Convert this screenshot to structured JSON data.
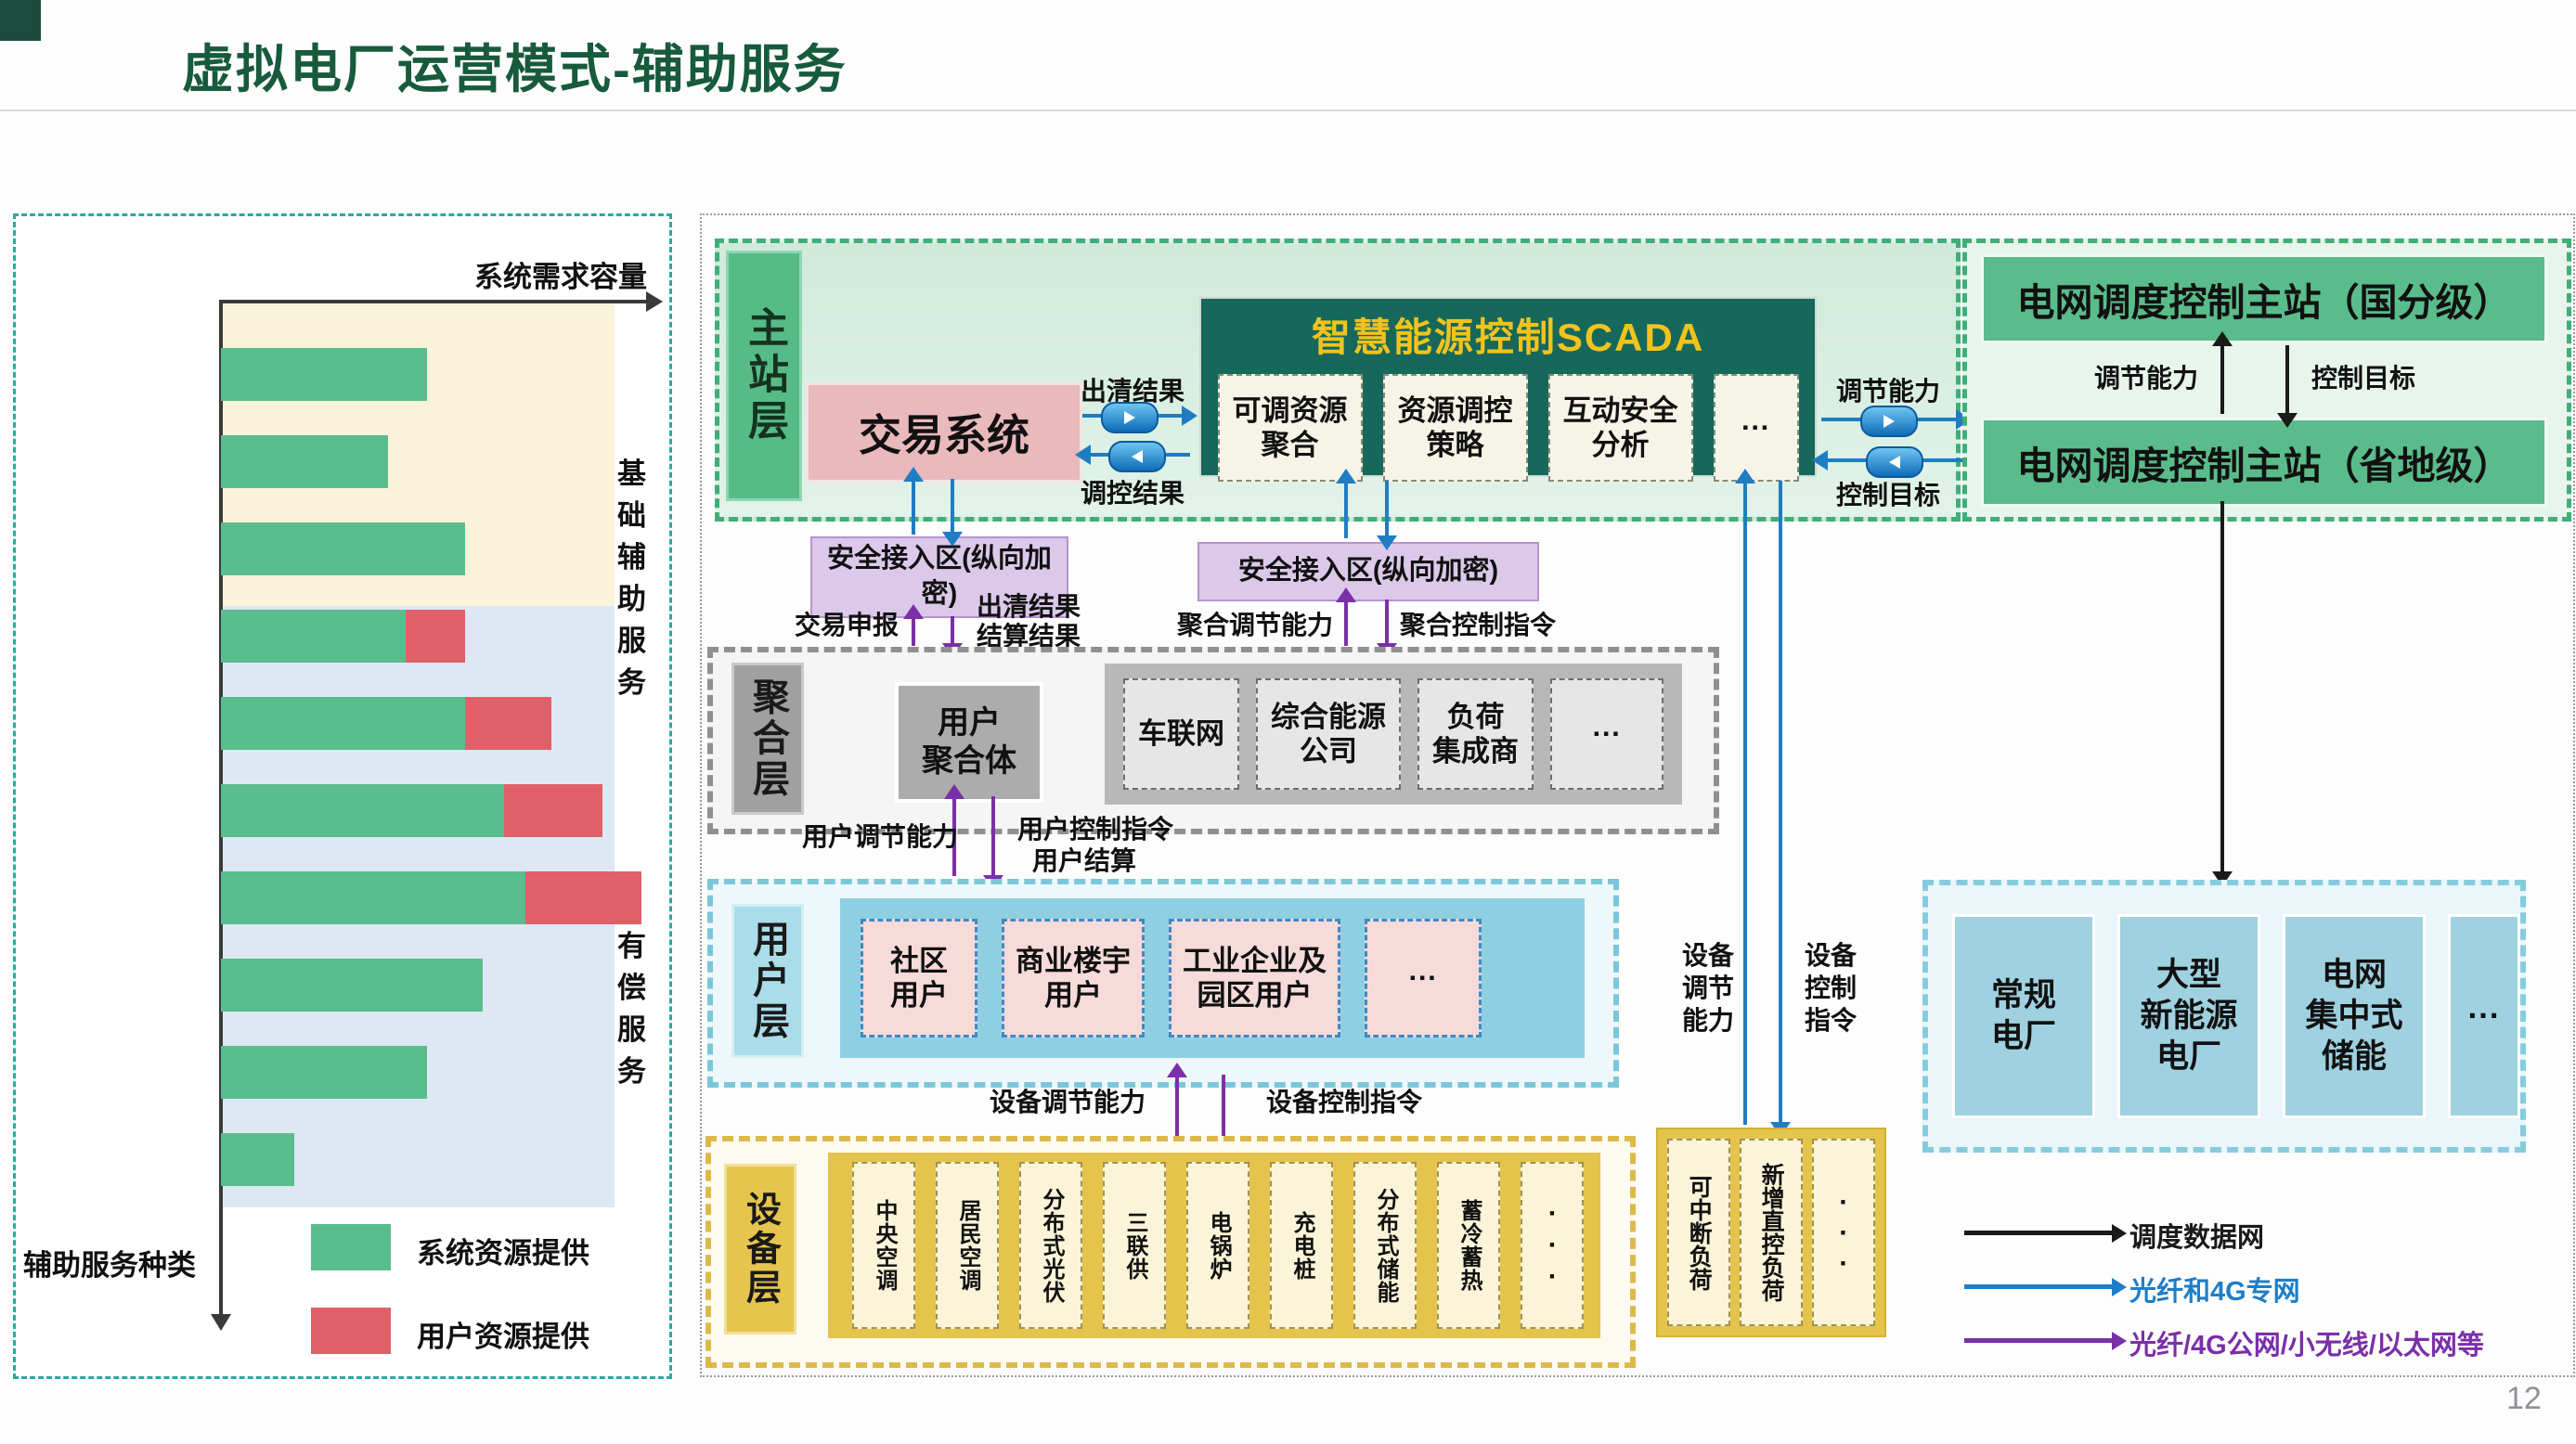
{
  "slide": {
    "title": "虚拟电厂运营模式-辅助服务",
    "page_number": "12"
  },
  "chart_data": {
    "type": "bar",
    "orientation": "horizontal",
    "xlabel": "系统需求容量",
    "ylabel": "辅助服务种类",
    "categories": [
      "一次调频",
      "基本调峰",
      "基本无功调节",
      "自动发电控制\nAGC",
      "旋转备用",
      "热备用",
      "有偿调峰",
      "有偿无功调节",
      "黑启动",
      ""
    ],
    "series": [
      {
        "name": "系统资源提供",
        "color": "#5abd8e",
        "values": [
          48,
          39,
          57,
          43,
          57,
          66,
          71,
          61,
          48,
          17
        ]
      },
      {
        "name": "用户资源提供",
        "color": "#e0606a",
        "values": [
          0,
          0,
          0,
          14,
          20,
          23,
          27,
          0,
          0,
          0
        ]
      }
    ],
    "xlim": [
      0,
      100
    ],
    "grid": false,
    "region_labels": [
      {
        "label": "基础\n辅助\n服务",
        "meaning": "基础辅助服务",
        "covers": "一次调频~基本无功调节"
      },
      {
        "label": "有偿\n服务",
        "meaning": "有偿服务",
        "covers": "自动发电控制AGC~黑启动"
      }
    ],
    "region_colors": {
      "basic": "#faf3d9",
      "paid": "#dde8f4"
    }
  },
  "diagram": {
    "layers": {
      "main": "主站层",
      "aggregation": "聚合层",
      "user": "用户层",
      "device": "设备层"
    },
    "trading_system": "交易系统",
    "scada": {
      "title": "智慧能源控制SCADA",
      "modules": [
        "可调资源\n聚合",
        "资源调控\n策略",
        "互动安全\n分析",
        "···"
      ]
    },
    "trading_scada_flows": {
      "right": "出清结果",
      "left": "调控结果"
    },
    "scada_dispatch_flows": {
      "up": "调节能力",
      "down": "控制目标"
    },
    "dispatch": {
      "national": "电网调度控制主站（国分级）",
      "provincial": "电网调度控制主站（省地级）",
      "up": "调节能力",
      "down": "控制目标"
    },
    "security_zone_left": {
      "label": "安全接入区(纵向加密)",
      "up": "交易申报",
      "down1": "出清结果",
      "down2": "结算结果"
    },
    "security_zone_right": {
      "label": "安全接入区(纵向加密)",
      "up": "聚合调节能力",
      "down": "聚合控制指令"
    },
    "aggregation": {
      "aggregator": "用户\n聚合体",
      "entities": [
        "车联网",
        "综合能源\n公司",
        "负荷\n集成商",
        "···"
      ]
    },
    "agg_user_flows": {
      "up": "用户调节能力",
      "down": "用户控制指令",
      "down2": "用户结算"
    },
    "user_groups": [
      "社区\n用户",
      "商业楼宇\n用户",
      "工业企业及\n园区用户",
      "···"
    ],
    "user_device_flows": {
      "up": "设备调节能力",
      "down": "设备控制指令"
    },
    "devices": [
      "中央空调",
      "居民空调",
      "分布式光伏",
      "三联供",
      "电锅炉",
      "充电桩",
      "分布式储能",
      "蓄冷蓄热",
      "···"
    ],
    "direct_loads": {
      "items": [
        "可中断负荷",
        "新增直控负荷",
        "···"
      ],
      "up": "设备\n调节\n能力",
      "down": "设备\n控制\n指令"
    },
    "plants": [
      "常规\n电厂",
      "大型\n新能源\n电厂",
      "电网\n集中式\n储能",
      "···"
    ],
    "network_legend": [
      {
        "label": "调度数据网",
        "color": "#1a1a1a"
      },
      {
        "label": "光纤和4G专网",
        "color": "#1e7ec8"
      },
      {
        "label": "光纤/4G公网/小无线/以太网等",
        "color": "#7b2fa8"
      }
    ]
  }
}
